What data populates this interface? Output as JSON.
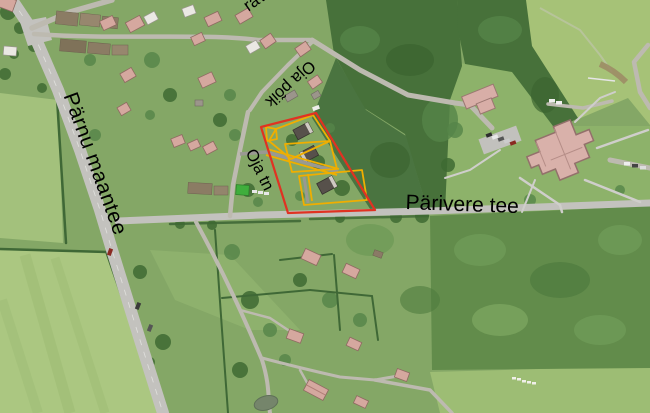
{
  "map": {
    "labels": {
      "parnu_maantee": "Pärnu maantee",
      "parivere_tee": "Pärivere tee",
      "oja_poik": "Oja põik",
      "oja_tn": "Oja tn",
      "top_partial": "rav"
    },
    "overlay": {
      "parcel_outline_color": "#e03222",
      "lot_outline_color": "#f0ae00",
      "label_color": "#000000"
    },
    "terrain_colors": {
      "village_green": "#84a766",
      "field_light": "#a9c77e",
      "forest": "#47713a",
      "scrub": "#628c4b",
      "road_gray": "#c3c2be"
    }
  }
}
